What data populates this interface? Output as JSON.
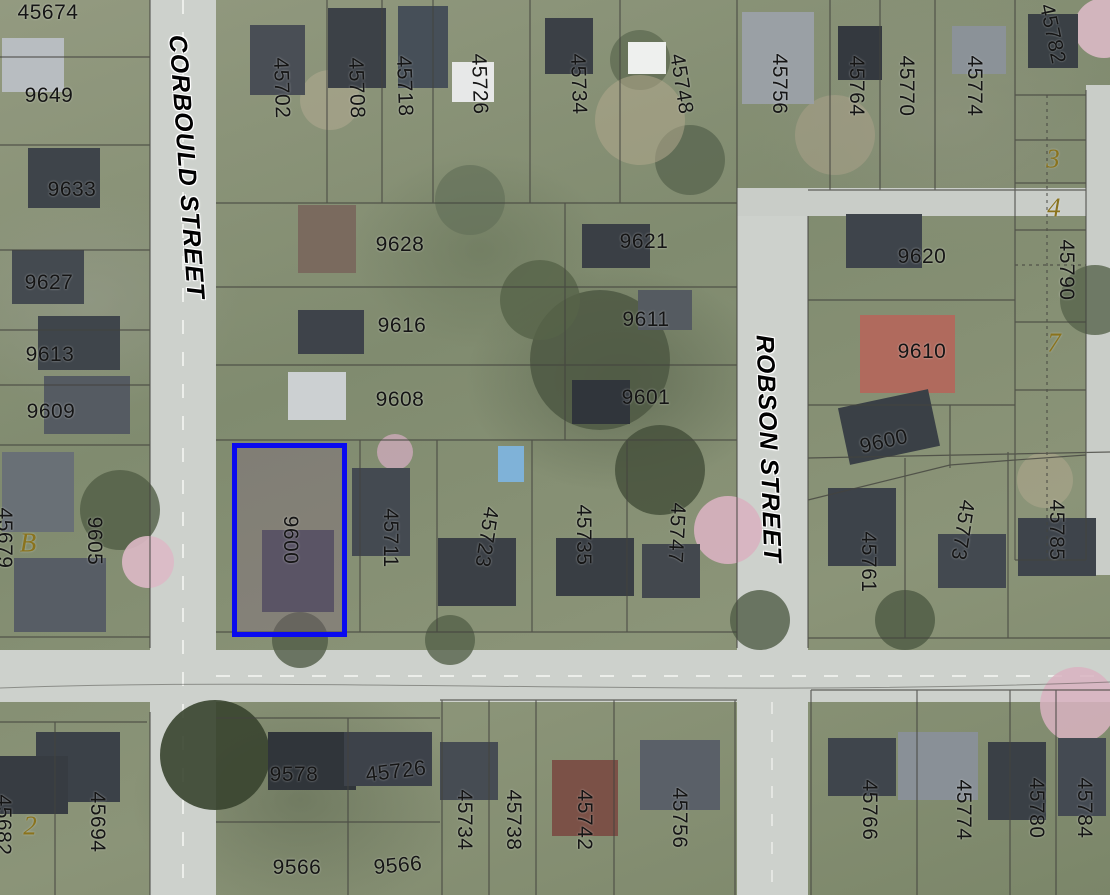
{
  "map": {
    "streets": [
      {
        "name": "CORBOULD STREET",
        "x": 186,
        "y": 167,
        "rotation": 86
      },
      {
        "name": "ROBSON STREET",
        "x": 768,
        "y": 449,
        "rotation": 88
      }
    ],
    "highlighted_parcel": {
      "address": "9600",
      "x": 232,
      "y": 443,
      "width": 115,
      "height": 194,
      "label_rotation": 90,
      "outline_color": "#0a0af0"
    },
    "address_labels": [
      {
        "text": "45674",
        "x": 48,
        "y": 13,
        "rotation": 0
      },
      {
        "text": "9649",
        "x": 49,
        "y": 96,
        "rotation": 0
      },
      {
        "text": "9633",
        "x": 72,
        "y": 190,
        "rotation": 0
      },
      {
        "text": "9627",
        "x": 49,
        "y": 283,
        "rotation": 0
      },
      {
        "text": "9613",
        "x": 50,
        "y": 355,
        "rotation": 0
      },
      {
        "text": "9609",
        "x": 51,
        "y": 412,
        "rotation": 0
      },
      {
        "text": "9605",
        "x": 94,
        "y": 541,
        "rotation": 90
      },
      {
        "text": "45679",
        "x": 4,
        "y": 538,
        "rotation": 90
      },
      {
        "text": "45694",
        "x": 97,
        "y": 822,
        "rotation": 90
      },
      {
        "text": "45682",
        "x": 3,
        "y": 825,
        "rotation": 90
      },
      {
        "text": "45702",
        "x": 281,
        "y": 88,
        "rotation": 88
      },
      {
        "text": "45708",
        "x": 356,
        "y": 88,
        "rotation": 88
      },
      {
        "text": "45718",
        "x": 404,
        "y": 86,
        "rotation": 88
      },
      {
        "text": "45726",
        "x": 479,
        "y": 84,
        "rotation": 88
      },
      {
        "text": "45734",
        "x": 578,
        "y": 84,
        "rotation": 88
      },
      {
        "text": "45748",
        "x": 681,
        "y": 84,
        "rotation": 81
      },
      {
        "text": "45756",
        "x": 779,
        "y": 84,
        "rotation": 90
      },
      {
        "text": "45764",
        "x": 856,
        "y": 86,
        "rotation": 90
      },
      {
        "text": "45770",
        "x": 906,
        "y": 86,
        "rotation": 90
      },
      {
        "text": "45774",
        "x": 974,
        "y": 86,
        "rotation": 90
      },
      {
        "text": "45782",
        "x": 1052,
        "y": 34,
        "rotation": 78
      },
      {
        "text": "9628",
        "x": 400,
        "y": 245,
        "rotation": 0
      },
      {
        "text": "9621",
        "x": 644,
        "y": 242,
        "rotation": 0
      },
      {
        "text": "9616",
        "x": 402,
        "y": 326,
        "rotation": 0
      },
      {
        "text": "9611",
        "x": 646,
        "y": 320,
        "rotation": 0
      },
      {
        "text": "9608",
        "x": 400,
        "y": 400,
        "rotation": 0
      },
      {
        "text": "9601",
        "x": 646,
        "y": 398,
        "rotation": 0
      },
      {
        "text": "9620",
        "x": 922,
        "y": 257,
        "rotation": 0
      },
      {
        "text": "9610",
        "x": 922,
        "y": 352,
        "rotation": 0
      },
      {
        "text": "9600",
        "x": 884,
        "y": 442,
        "rotation": -13
      },
      {
        "text": "45790",
        "x": 1066,
        "y": 270,
        "rotation": 90
      },
      {
        "text": "45711",
        "x": 390,
        "y": 538,
        "rotation": 90
      },
      {
        "text": "45723",
        "x": 486,
        "y": 537,
        "rotation": 99
      },
      {
        "text": "45735",
        "x": 583,
        "y": 535,
        "rotation": 90
      },
      {
        "text": "45747",
        "x": 676,
        "y": 533,
        "rotation": 93
      },
      {
        "text": "45761",
        "x": 868,
        "y": 562,
        "rotation": 90
      },
      {
        "text": "45773",
        "x": 962,
        "y": 530,
        "rotation": 99
      },
      {
        "text": "45785",
        "x": 1056,
        "y": 530,
        "rotation": 90
      },
      {
        "text": "9578",
        "x": 294,
        "y": 775,
        "rotation": 0
      },
      {
        "text": "45726",
        "x": 396,
        "y": 772,
        "rotation": -7
      },
      {
        "text": "45734",
        "x": 464,
        "y": 820,
        "rotation": 90
      },
      {
        "text": "45738",
        "x": 513,
        "y": 820,
        "rotation": 90
      },
      {
        "text": "45742",
        "x": 584,
        "y": 820,
        "rotation": 90
      },
      {
        "text": "45756",
        "x": 679,
        "y": 818,
        "rotation": 90
      },
      {
        "text": "45766",
        "x": 869,
        "y": 810,
        "rotation": 90
      },
      {
        "text": "45774",
        "x": 963,
        "y": 810,
        "rotation": 90
      },
      {
        "text": "45780",
        "x": 1036,
        "y": 808,
        "rotation": 90
      },
      {
        "text": "45784",
        "x": 1084,
        "y": 808,
        "rotation": 90
      },
      {
        "text": "9566",
        "x": 297,
        "y": 868,
        "rotation": 0
      },
      {
        "text": "9566",
        "x": 398,
        "y": 866,
        "rotation": -5
      }
    ],
    "plan_labels": [
      {
        "text": "B",
        "x": 28,
        "y": 543
      },
      {
        "text": "2",
        "x": 30,
        "y": 826
      },
      {
        "text": "3",
        "x": 1053,
        "y": 159
      },
      {
        "text": "4",
        "x": 1054,
        "y": 208
      },
      {
        "text": "7",
        "x": 1054,
        "y": 343
      }
    ],
    "colors": {
      "address_label": "#151515",
      "street_label": "#000000",
      "plan_label": "#8a731d",
      "parcel_line": "#44443f",
      "road": "#cdd1cc",
      "highlight_outline": "#0a0af0"
    }
  }
}
